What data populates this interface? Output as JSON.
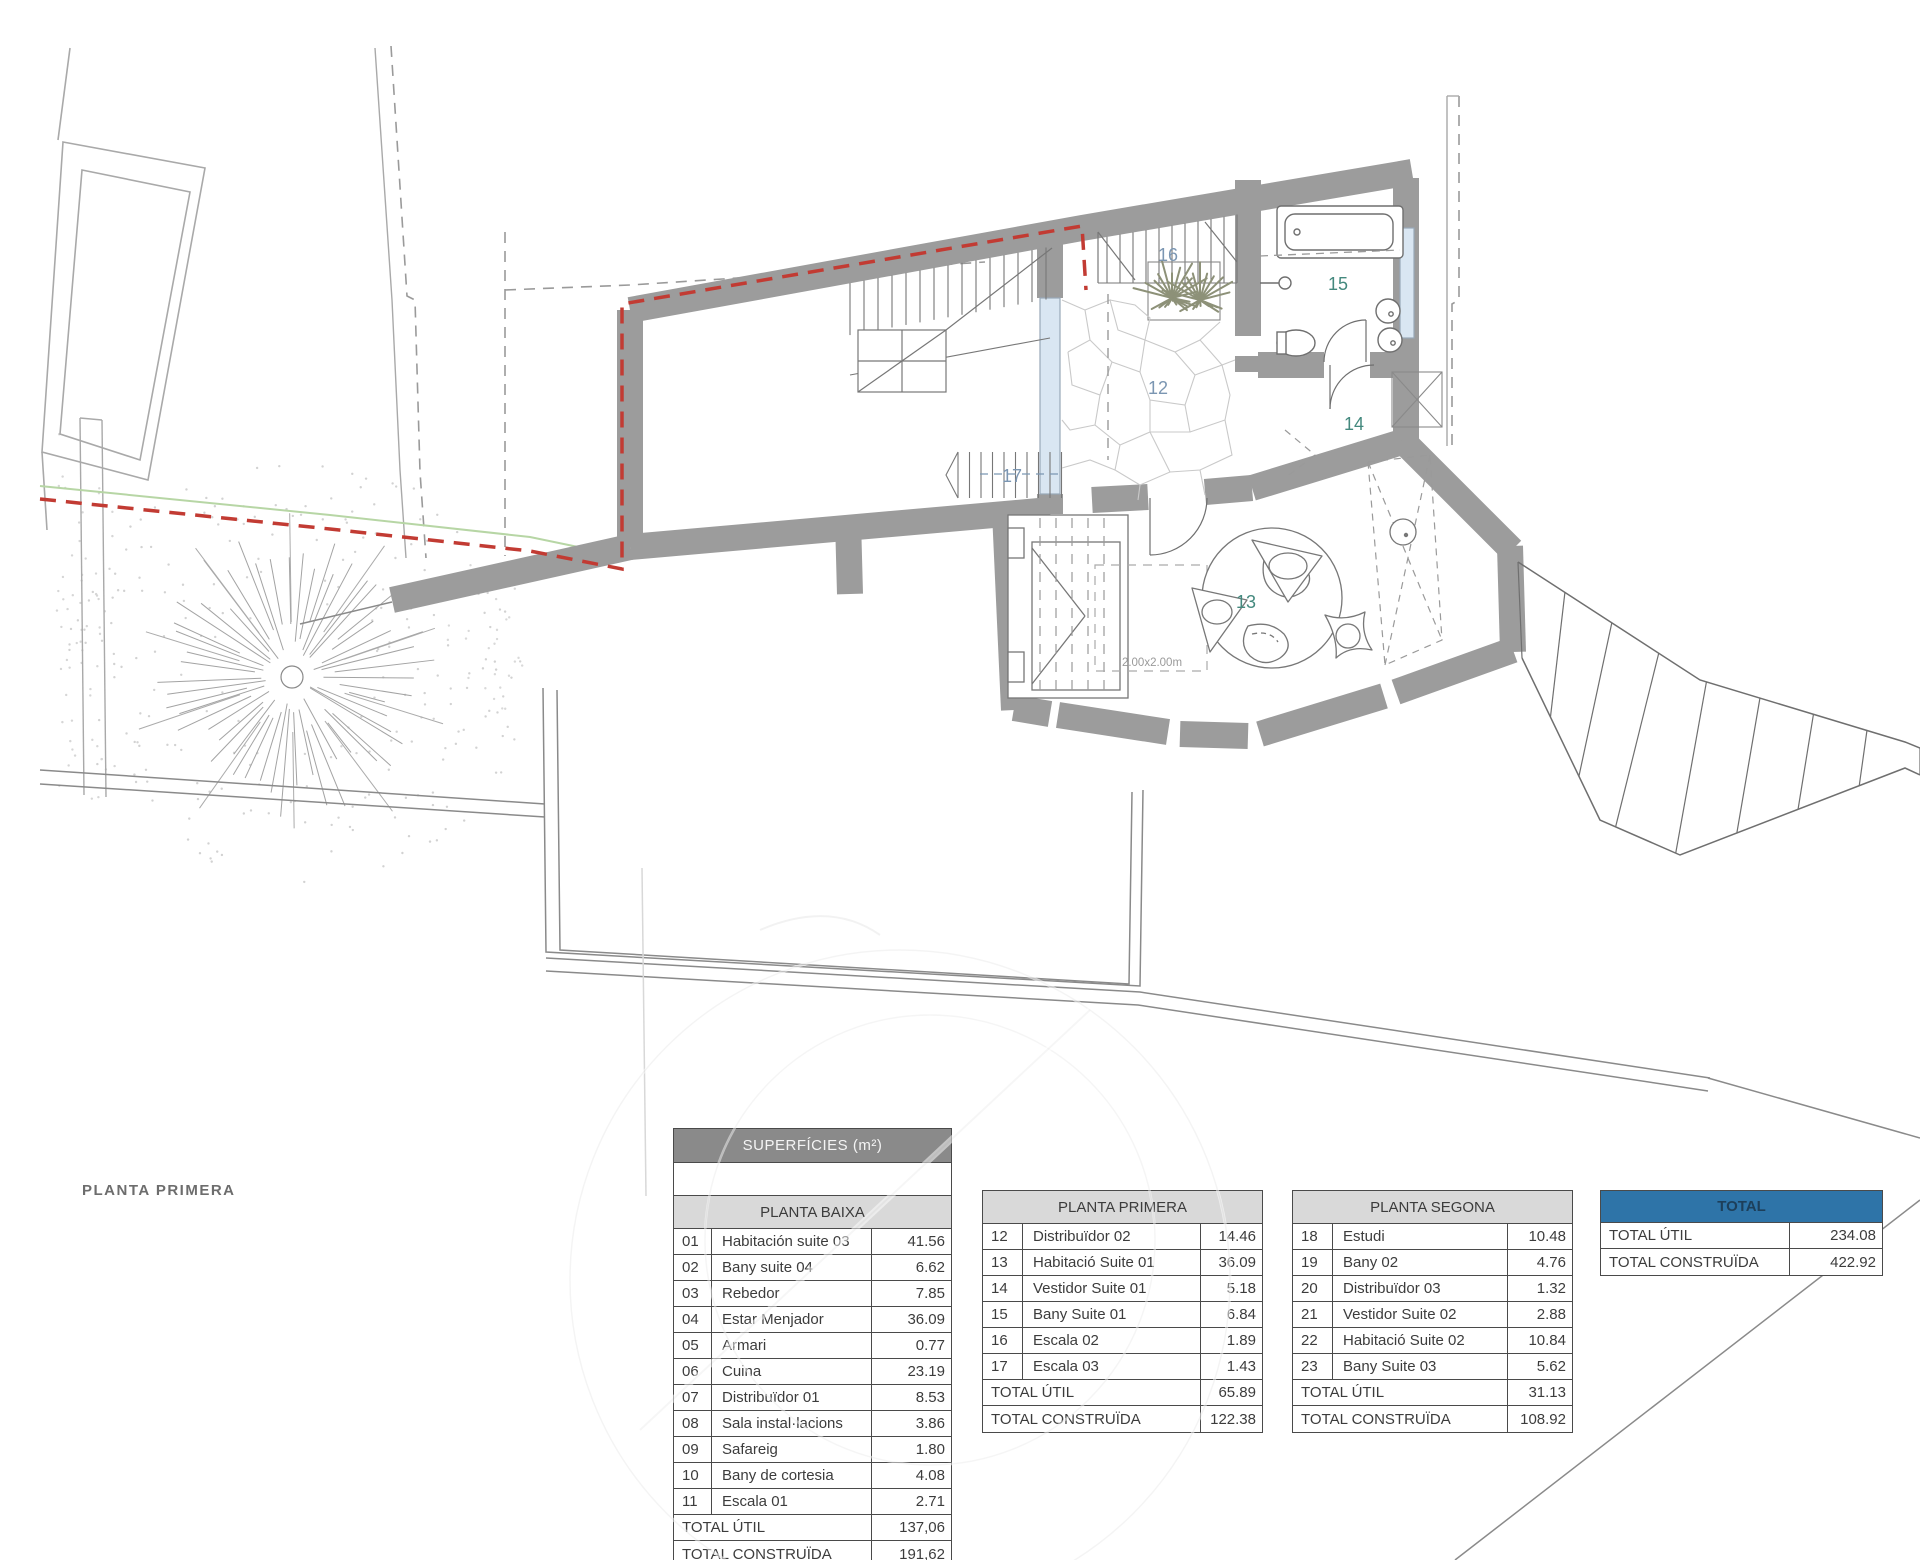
{
  "plan": {
    "title": "PLANTA PRIMERA",
    "dim_label": "2.00x2.00m",
    "rooms": {
      "r12": "12",
      "r13": "13",
      "r14": "14",
      "r15": "15",
      "r16": "16",
      "r17": "17"
    }
  },
  "tables": {
    "baixa": {
      "header": "SUPERFÍCIES (m²)",
      "subheader": "PLANTA BAIXA",
      "rows": [
        [
          "01",
          "Habitación suite 03",
          "41.56"
        ],
        [
          "02",
          "Bany suite 04",
          "6.62"
        ],
        [
          "03",
          "Rebedor",
          "7.85"
        ],
        [
          "04",
          "Estar Menjador",
          "36.09"
        ],
        [
          "05",
          "Armari",
          "0.77"
        ],
        [
          "06",
          "Cuina",
          "23.19"
        ],
        [
          "07",
          "Distribuïdor 01",
          "8.53"
        ],
        [
          "08",
          "Sala instal·lacions",
          "3.86"
        ],
        [
          "09",
          "Safareig",
          "1.80"
        ],
        [
          "10",
          "Bany de cortesia",
          "4.08"
        ],
        [
          "11",
          "Escala 01",
          "2.71"
        ]
      ],
      "totals": [
        [
          "TOTAL ÚTIL",
          "137,06"
        ],
        [
          "TOTAL CONSTRUÏDA",
          "191,62"
        ]
      ]
    },
    "primera": {
      "subheader": "PLANTA PRIMERA",
      "rows": [
        [
          "12",
          "Distribuïdor 02",
          "14.46"
        ],
        [
          "13",
          "Habitació Suite 01",
          "36.09"
        ],
        [
          "14",
          "Vestidor Suite 01",
          "5.18"
        ],
        [
          "15",
          "Bany Suite 01",
          "6.84"
        ],
        [
          "16",
          "Escala 02",
          "1.89"
        ],
        [
          "17",
          "Escala 03",
          "1.43"
        ]
      ],
      "totals": [
        [
          "TOTAL ÚTIL",
          "65.89"
        ],
        [
          "TOTAL CONSTRUÏDA",
          "122.38"
        ]
      ]
    },
    "segona": {
      "subheader": "PLANTA SEGONA",
      "rows": [
        [
          "18",
          "Estudi",
          "10.48"
        ],
        [
          "19",
          "Bany 02",
          "4.76"
        ],
        [
          "20",
          "Distribuïdor 03",
          "1.32"
        ],
        [
          "21",
          "Vestidor Suite 02",
          "2.88"
        ],
        [
          "22",
          "Habitació Suite 02",
          "10.84"
        ],
        [
          "23",
          "Bany Suite 03",
          "5.62"
        ]
      ],
      "totals": [
        [
          "TOTAL ÚTIL",
          "31.13"
        ],
        [
          "TOTAL CONSTRUÏDA",
          "108.92"
        ]
      ]
    },
    "total": {
      "header": "TOTAL",
      "totals": [
        [
          "TOTAL ÚTIL",
          "234.08"
        ],
        [
          "TOTAL CONSTRUÏDA",
          "422.92"
        ]
      ]
    }
  },
  "colors": {
    "wall_gray": "#9c9c9c",
    "boundary_red": "#c23b33",
    "boundary_green": "#b7d6a5",
    "window_blue": "#d9e6f2",
    "header_dark_bg": "#8a8a8a",
    "header_light_bg": "#d9d9d9",
    "header_blue_bg": "#2e74a8",
    "room_label_blue": "#7b96b2",
    "room_label_teal": "#44897e"
  }
}
